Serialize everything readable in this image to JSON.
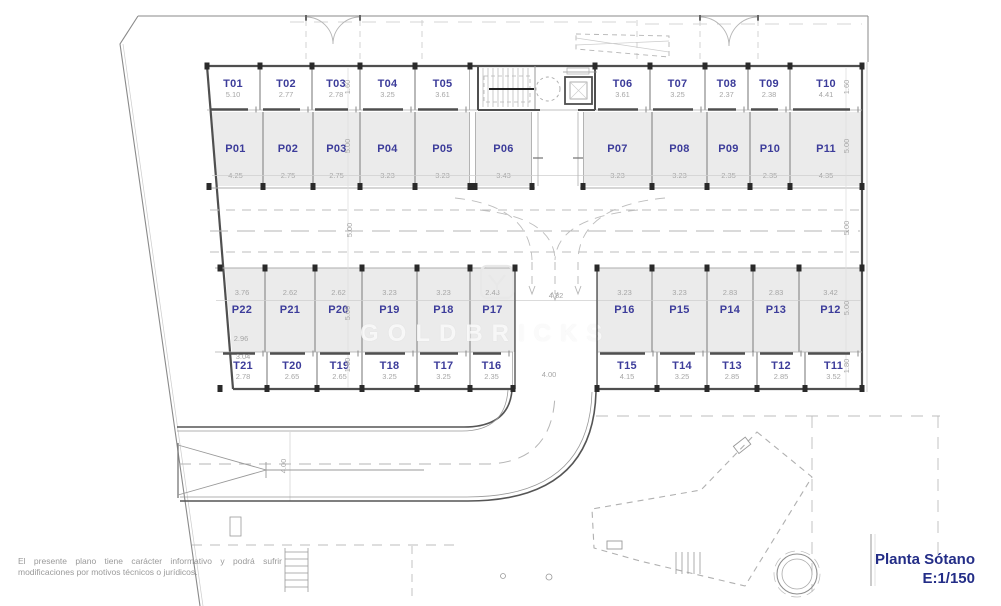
{
  "title": {
    "name": "Planta Sótano",
    "scale": "E:1/150"
  },
  "disclaimer": "El presente plano tiene carácter informativo y podrá sufrir modificaciones por motivos técnicos o jurídicos.",
  "watermark": "GOLDBRICKS",
  "colors": {
    "label": "#3c3c9a",
    "dim": "#a6a6a6",
    "title": "#232d87",
    "stall_fill": "#ebebeb",
    "wall": "#4f4f4f"
  },
  "plan": {
    "rows": {
      "storage_top": {
        "y": 67,
        "h": 43,
        "open": "bottom",
        "kind": "storage",
        "units": [
          {
            "label": "T01",
            "dim": "5.10",
            "x": 207,
            "w": 53,
            "clip": [
              0,
              5
            ]
          },
          {
            "label": "T02",
            "dim": "2.77",
            "x": 260,
            "w": 52
          },
          {
            "label": "T03",
            "dim": "2.78",
            "x": 312,
            "w": 48
          },
          {
            "label": "T04",
            "dim": "3.25",
            "x": 360,
            "w": 55
          },
          {
            "label": "T05",
            "dim": "3.61",
            "x": 415,
            "w": 55
          },
          {
            "label": "T06",
            "dim": "3.61",
            "x": 595,
            "w": 55
          },
          {
            "label": "T07",
            "dim": "3.25",
            "x": 650,
            "w": 55
          },
          {
            "label": "T08",
            "dim": "2.37",
            "x": 705,
            "w": 43
          },
          {
            "label": "T09",
            "dim": "2.38",
            "x": 748,
            "w": 42
          },
          {
            "label": "T10",
            "dim": "4.41",
            "x": 790,
            "w": 72
          }
        ]
      },
      "parking_top": {
        "y": 112,
        "h": 74,
        "open": "bottom",
        "kind": "parking",
        "units": [
          {
            "label": "P01",
            "dim": "4.25",
            "x": 209,
            "w": 54,
            "clip": [
              2,
              8
            ]
          },
          {
            "label": "P02",
            "dim": "2.75",
            "x": 263,
            "w": 50
          },
          {
            "label": "P03",
            "dim": "2.75",
            "x": 313,
            "w": 47
          },
          {
            "label": "P04",
            "dim": "3.23",
            "x": 360,
            "w": 55
          },
          {
            "label": "P05",
            "dim": "3.23",
            "x": 415,
            "w": 55
          },
          {
            "label": "P06",
            "dim": "3.43",
            "x": 475,
            "w": 57
          },
          {
            "label": "P07",
            "dim": "3.23",
            "x": 583,
            "w": 69
          },
          {
            "label": "P08",
            "dim": "3.23",
            "x": 652,
            "w": 55
          },
          {
            "label": "P09",
            "dim": "2.35",
            "x": 707,
            "w": 43
          },
          {
            "label": "P10",
            "dim": "2.35",
            "x": 750,
            "w": 40
          },
          {
            "label": "P11",
            "dim": "4.35",
            "x": 790,
            "w": 72
          }
        ]
      },
      "parking_bottom": {
        "y": 268,
        "h": 84,
        "open": "top",
        "kind": "parking",
        "units": [
          {
            "label": "P22",
            "dim": "3.76",
            "x": 220,
            "w": 45,
            "clip": [
              5,
              12
            ]
          },
          {
            "label": "P21",
            "dim": "2.62",
            "x": 265,
            "w": 50
          },
          {
            "label": "P20",
            "dim": "2.62",
            "x": 315,
            "w": 47
          },
          {
            "label": "P19",
            "dim": "3.23",
            "x": 362,
            "w": 55
          },
          {
            "label": "P18",
            "dim": "3.23",
            "x": 417,
            "w": 53
          },
          {
            "label": "P17",
            "dim": "2.43",
            "x": 470,
            "w": 45
          },
          {
            "label": "P16",
            "dim": "3.23",
            "x": 597,
            "w": 55
          },
          {
            "label": "P15",
            "dim": "3.23",
            "x": 652,
            "w": 55
          },
          {
            "label": "P14",
            "dim": "2.83",
            "x": 707,
            "w": 46
          },
          {
            "label": "P13",
            "dim": "2.83",
            "x": 753,
            "w": 46
          },
          {
            "label": "P12",
            "dim": "3.42",
            "x": 799,
            "w": 63
          }
        ]
      },
      "storage_bottom": {
        "y": 352,
        "h": 38,
        "open": "top",
        "kind": "storage",
        "units": [
          {
            "label": "T21",
            "dim": "2.78",
            "x": 220,
            "w": 47,
            "clip": [
              9,
              12
            ]
          },
          {
            "label": "T20",
            "dim": "2.65",
            "x": 267,
            "w": 50
          },
          {
            "label": "T19",
            "dim": "2.65",
            "x": 317,
            "w": 45
          },
          {
            "label": "T18",
            "dim": "3.25",
            "x": 362,
            "w": 55
          },
          {
            "label": "T17",
            "dim": "3.25",
            "x": 417,
            "w": 53
          },
          {
            "label": "T16",
            "dim": "2.35",
            "x": 470,
            "w": 43
          },
          {
            "label": "T15",
            "dim": "4.15",
            "x": 597,
            "w": 60
          },
          {
            "label": "T14",
            "dim": "3.25",
            "x": 657,
            "w": 50
          },
          {
            "label": "T13",
            "dim": "2.85",
            "x": 707,
            "w": 50
          },
          {
            "label": "T12",
            "dim": "2.85",
            "x": 757,
            "w": 48
          },
          {
            "label": "T11",
            "dim": "3.52",
            "x": 805,
            "w": 57
          }
        ]
      }
    },
    "vertical_dims": [
      {
        "v": "1.60",
        "x": 348,
        "y": 87
      },
      {
        "v": "5.00",
        "x": 348,
        "y": 146
      },
      {
        "v": "5.00",
        "x": 350,
        "y": 230
      },
      {
        "v": "5.00",
        "x": 348,
        "y": 313
      },
      {
        "v": "1.60",
        "x": 348,
        "y": 365
      },
      {
        "v": "1.60",
        "x": 847,
        "y": 87
      },
      {
        "v": "5.00",
        "x": 847,
        "y": 146
      },
      {
        "v": "5.00",
        "x": 847,
        "y": 228
      },
      {
        "v": "5.00",
        "x": 847,
        "y": 308
      },
      {
        "v": "1.80",
        "x": 847,
        "y": 366
      }
    ],
    "extra_dims": [
      {
        "v": "4.82",
        "x": 556,
        "y": 296
      },
      {
        "v": "4.00",
        "x": 549,
        "y": 375
      },
      {
        "v": "2.96",
        "x": 241,
        "y": 339
      },
      {
        "v": "3.04",
        "x": 243,
        "y": 357
      },
      {
        "v": "4.00",
        "x": 284,
        "y": 466,
        "rot": true
      }
    ]
  }
}
